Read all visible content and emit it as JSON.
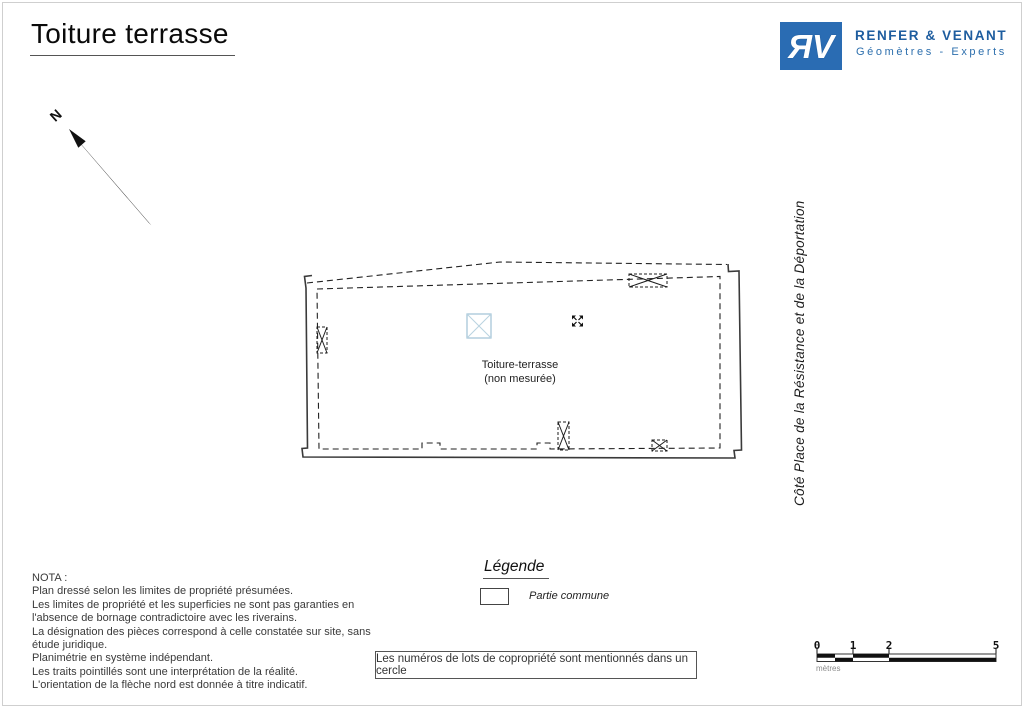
{
  "page": {
    "title": "Toiture terrasse"
  },
  "colors": {
    "accent_blue": "#2a6cb3",
    "text_blue": "#1e5d9f",
    "sub_blue": "#2d6fad",
    "plan_blue": "#9fc2d6",
    "plan_blue_light": "#b9d3e0"
  },
  "logo": {
    "monogram": "ЯV",
    "company": "RENFER & VENANT",
    "subtitle": "Géomètres - Experts"
  },
  "north": {
    "label": "N"
  },
  "plan": {
    "label_line1": "Toiture-terrasse",
    "label_line2": "(non mesurée)"
  },
  "side_label": "Côté Place de la Résistance et de la Déportation",
  "legend": {
    "title": "Légende",
    "items": [
      {
        "swatch": "partie-commune-white",
        "label": "Partie commune"
      }
    ]
  },
  "nota": {
    "heading": "NOTA :",
    "text": "Plan dressé selon les limites de propriété présumées.\nLes limites de propriété et les superficies ne sont pas garanties en\nl'absence de bornage contradictoire avec les riverains.\nLa désignation des pièces correspond à celle constatée sur site, sans\nétude juridique.\nPlanimétrie en système indépendant.\nLes traits pointillés sont une interprétation de la réalité.\nL'orientation de la flèche nord est donnée à titre indicatif."
  },
  "note_box": "Les numéros de lots de copropriété sont mentionnés dans un cercle",
  "scale_bar": {
    "ticks": [
      "0",
      "1",
      "2",
      "5"
    ],
    "unit": "mètres"
  }
}
